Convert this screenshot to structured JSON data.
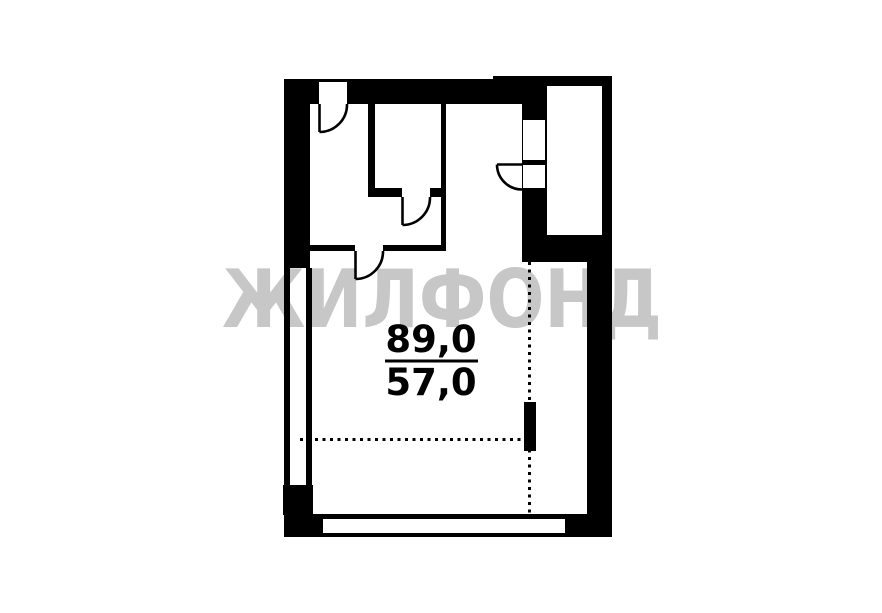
{
  "colors": {
    "background": "#ffffff",
    "ink": "#000000",
    "watermark": "#c7c7c7"
  },
  "watermark": {
    "text": "ЖИЛФОНД",
    "x": 222,
    "y": 327,
    "font_size": 80,
    "text_length": 440
  },
  "area_label": {
    "total": "89,0",
    "living": "57,0",
    "center_x": 431,
    "total_baseline": 352,
    "living_baseline": 395,
    "font_size": 37,
    "divider": {
      "x1": 385,
      "x2": 478,
      "y": 361,
      "thickness": 3
    }
  },
  "plan": {
    "canvas": {
      "width": 882,
      "height": 613
    },
    "stroke_width": 2.6,
    "dotted_stroke_width": 3,
    "dash_pattern": "3 4.5",
    "walls": [
      {
        "name": "top-wall",
        "x": 284,
        "y": 79,
        "w": 263,
        "h": 25
      },
      {
        "name": "stair-shaft-top-wall",
        "x": 493,
        "y": 76,
        "w": 119,
        "h": 10
      },
      {
        "name": "stair-shaft-right-wall",
        "x": 602,
        "y": 76,
        "w": 10,
        "h": 159
      },
      {
        "name": "entry-wall",
        "x": 522,
        "y": 79,
        "w": 25,
        "h": 156
      },
      {
        "name": "wall-below-shaft",
        "x": 522,
        "y": 235,
        "w": 90,
        "h": 27
      },
      {
        "name": "right-wall",
        "x": 587,
        "y": 262,
        "w": 25,
        "h": 275
      },
      {
        "name": "bottom-wall",
        "x": 284,
        "y": 514,
        "w": 328,
        "h": 23
      },
      {
        "name": "bottom-left-corner-block",
        "x": 283,
        "y": 485,
        "w": 30,
        "h": 30
      },
      {
        "name": "left-wall",
        "x": 284,
        "y": 79,
        "w": 26,
        "h": 189
      },
      {
        "name": "left-window-outer-line",
        "x": 284,
        "y": 268,
        "w": 6,
        "h": 217
      },
      {
        "name": "left-window-inner-line",
        "x": 306,
        "y": 268,
        "w": 6,
        "h": 217
      },
      {
        "name": "closet-left-wall",
        "x": 368,
        "y": 104,
        "w": 7,
        "h": 84
      },
      {
        "name": "closet-bottom-wall",
        "x": 368,
        "y": 188,
        "w": 78,
        "h": 9
      },
      {
        "name": "corridor-wall",
        "x": 441,
        "y": 104,
        "w": 5,
        "h": 147
      },
      {
        "name": "room-divider-wall",
        "x": 310,
        "y": 245,
        "w": 136,
        "h": 6
      },
      {
        "name": "wall-stub",
        "x": 524,
        "y": 402,
        "w": 12,
        "h": 49
      }
    ],
    "openings": [
      {
        "name": "top-door-opening",
        "x": 319,
        "y": 82,
        "w": 28,
        "h": 22
      },
      {
        "name": "entry-niche-opening",
        "x": 523,
        "y": 120,
        "w": 22,
        "h": 40
      },
      {
        "name": "entry-door-opening",
        "x": 523,
        "y": 165,
        "w": 22,
        "h": 23
      },
      {
        "name": "closet-door-opening",
        "x": 402,
        "y": 188,
        "w": 28,
        "h": 9
      },
      {
        "name": "divider-door-opening",
        "x": 355,
        "y": 245,
        "w": 28,
        "h": 6
      },
      {
        "name": "bottom-window",
        "x": 323,
        "y": 519,
        "w": 242,
        "h": 14
      }
    ],
    "doors": [
      {
        "name": "top-door",
        "leaf": [
          319.5,
          104,
          319.5,
          132
        ],
        "arc": "M 319.5 132 A 27.5 27.5 0 0 0 347 104"
      },
      {
        "name": "divider-door",
        "leaf": [
          355.5,
          251,
          355.5,
          279
        ],
        "arc": "M 355.5 279 A 27.5 27.5 0 0 0 383 251"
      },
      {
        "name": "closet-door",
        "leaf": [
          402.5,
          197,
          402.5,
          225
        ],
        "arc": "M 402.5 225 A 27.5 27.5 0 0 0 430 197"
      },
      {
        "name": "entry-door",
        "leaf": [
          497,
          164.5,
          522,
          164.5
        ],
        "arc": "M 497 164.5 A 25 25 0 0 0 522 189.5"
      }
    ],
    "dotted_lines": [
      {
        "name": "vertical-area-divider",
        "x1": 529.5,
        "y1": 262,
        "x2": 529.5,
        "y2": 514
      },
      {
        "name": "horizontal-area-divider",
        "x1": 300,
        "y1": 439.5,
        "x2": 524,
        "y2": 439.5
      }
    ]
  }
}
